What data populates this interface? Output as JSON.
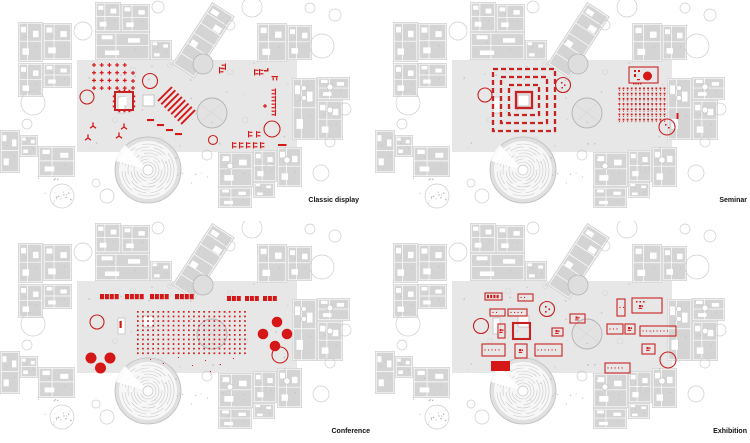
{
  "page": {
    "background": "#ffffff"
  },
  "colors": {
    "accent_red": "#c82121",
    "accent_red_fill": "#d61717",
    "block_gray": "#d4d4d4",
    "hall_gray": "#e7e7e7",
    "line_gray": "#c9c9c9",
    "label_text": "#111111"
  },
  "plans": [
    {
      "id": "classic-display",
      "label": "Classic display"
    },
    {
      "id": "seminar",
      "label": "Seminar"
    },
    {
      "id": "conference",
      "label": "Conference"
    },
    {
      "id": "exhibition",
      "label": "Exhibition"
    }
  ]
}
